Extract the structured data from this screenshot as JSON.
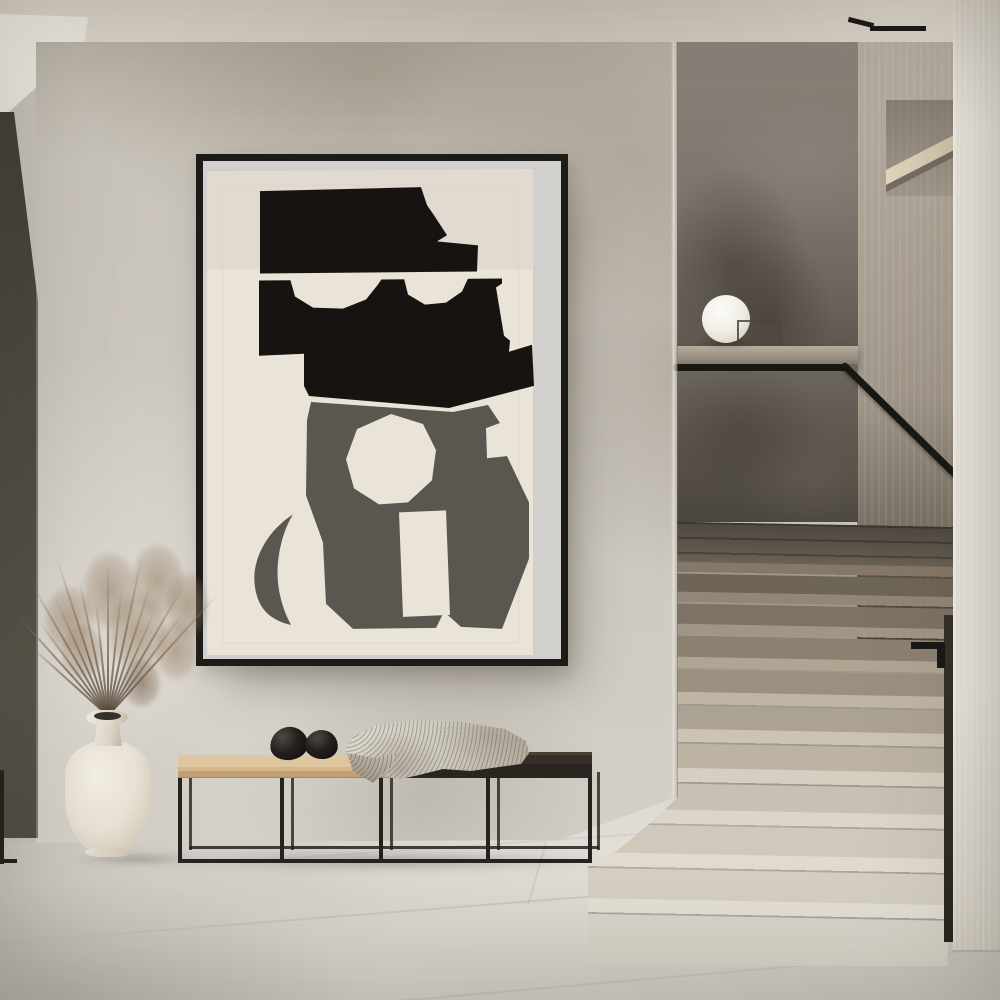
{
  "scene": {
    "description": "Minimalist hallway interior: large black-framed abstract cut-out poster on a plaster wall, black metal bench with beige and dark seat, two black stone eggs and a knit throw, cream vase with dried grass, white sphere lamp on a concrete stair parapet, black handrail and terrazzo stairs beside a white pillar",
    "objects": [
      {
        "label": "abstract poster in black frame"
      },
      {
        "label": "metal frame bench"
      },
      {
        "label": "black stone egg decor"
      },
      {
        "label": "knitted waffle throw"
      },
      {
        "label": "ceramic jar vase"
      },
      {
        "label": "dried grass bouquet"
      },
      {
        "label": "sphere table lamp"
      },
      {
        "label": "terrazzo staircase"
      },
      {
        "label": "black handrail"
      },
      {
        "label": "concrete half wall"
      },
      {
        "label": "wood wall shelf"
      },
      {
        "label": "white pillar"
      }
    ]
  },
  "palette": {
    "ceiling": "#d6cec1",
    "soffit": "#f2f0ea",
    "wall": "#c9c4bb",
    "dark_strip": "#4c4a42",
    "frame": "#1d1b18",
    "art_backing": "#d2d0cd",
    "art_paper": "#eae3d7",
    "art_black": "#161311",
    "art_gray": "#5a5650",
    "bench_metal": "#25221f",
    "bench_seat": "#d7bc93",
    "bench_dark": "#2f2a24",
    "blanket": "#cfcac0",
    "pebble": "#1c1916",
    "vase": "#e9e2d5",
    "grass": "#97816a",
    "panel": "#7d766d",
    "halfwall": "#615a52",
    "ledge": "#a0978a",
    "rail": "#191714",
    "right_wall": "#a89e92",
    "shelf": "#d7cab1",
    "pillar": "#e9e5dd",
    "lamp": "#f8f6f1",
    "floor": "#d2cec7",
    "grout": "#bdb9b2",
    "gap": "#2e2b26"
  },
  "poster": {
    "art_shapes": [
      {
        "name": "backing",
        "type": "rect",
        "x": 0,
        "y": 0,
        "w": 358,
        "h": 496,
        "fill": "art_backing"
      },
      {
        "name": "paper",
        "type": "polygon",
        "points": "4,10 330,8 330,492 4,492",
        "fill": "art_paper"
      },
      {
        "name": "paper-top-shade",
        "type": "rect",
        "x": 4,
        "y": 8,
        "w": 326,
        "h": 100,
        "fill": "#c9c7c3",
        "opacity": 0.3
      },
      {
        "name": "mat-line",
        "type": "rect",
        "x": 20,
        "y": 24,
        "w": 296,
        "h": 456,
        "fill": "none",
        "stroke": "#ded6c8",
        "opacity": 0.8
      },
      {
        "name": "gray-blob",
        "type": "polygon",
        "points": "108,240 250,250 285,243 297,261 283,266 284,296 304,294 326,340 326,396 299,466 258,464 241,449 233,465 150,466 123,441 120,380 103,333 104,258",
        "fill": "art_gray"
      },
      {
        "name": "gray-crescent",
        "type": "path",
        "d": "M 90,352 C 62,370 48,400 52,424 C 55,448 70,458 88,462 C 76,440 72,415 76,392 C 79,374 84,362 90,352 Z",
        "fill": "art_gray"
      },
      {
        "name": "black-hat",
        "type": "polygon",
        "points": "57,30 218,26 224,44 231,54 244,74 234,80 275,84 274,110 57,112",
        "fill": "art_black"
      },
      {
        "name": "black-mass",
        "type": "polygon",
        "points": "56,119 299,117 299,122 293,126 301,174 307,179 306,190 329,183 331,224 246,246 106,234 101,224 101,192 56,194",
        "fill": "art_black"
      },
      {
        "name": "eye-left",
        "type": "polygon",
        "points": "87,117 92,135 110,146 140,147 163,138 175,123 179,117",
        "fill": "art_paper"
      },
      {
        "name": "eye-right",
        "type": "polygon",
        "points": "201,117 205,133 222,143 243,141 259,130 265,117",
        "fill": "art_paper"
      },
      {
        "name": "cream-octagon",
        "type": "polygon",
        "points": "188,252 220,262 233,288 229,318 205,340 176,342 151,326 143,297 154,267",
        "fill": "art_paper"
      },
      {
        "name": "cream-slot",
        "type": "polygon",
        "points": "196,350 243,348 247,452 200,454",
        "fill": "art_paper"
      }
    ]
  },
  "stairs": {
    "visible_step_count": 10,
    "steps": [
      {
        "top": 898,
        "h": 64,
        "split": 14,
        "left": 586,
        "tread": "#e3ded4",
        "riser": "#d8d3c9"
      },
      {
        "top": 852,
        "h": 46,
        "split": 14,
        "left": 586,
        "tread": "#e0dacf",
        "riser": "#d4cec3"
      },
      {
        "top": 808,
        "h": 44,
        "split": 14,
        "left": 586,
        "tread": "#dcd5c9",
        "riser": "#cfc8bb"
      },
      {
        "top": 766,
        "h": 42,
        "split": 14,
        "left": 586,
        "tread": "#d6cec1",
        "riser": "#c8c0b2"
      },
      {
        "top": 727,
        "h": 39,
        "split": 13,
        "left": 586,
        "tread": "#cdc3b4",
        "riser": "#bcb3a3"
      },
      {
        "top": 690,
        "h": 37,
        "split": 12,
        "left": 586,
        "tread": "#c0b5a4",
        "riser": "#aca293"
      },
      {
        "top": 655,
        "h": 35,
        "split": 11,
        "left": 586,
        "tread": "#b0a493",
        "riser": "#9b9080"
      },
      {
        "top": 622,
        "h": 33,
        "split": 10,
        "left": 586,
        "tread": "#a19585",
        "riser": "#8c8171"
      },
      {
        "top": 590,
        "h": 32,
        "split": 10,
        "left": 586,
        "tread": "#938676",
        "riser": "#7d7263"
      },
      {
        "top": 560,
        "h": 30,
        "split": 10,
        "left": 586,
        "tread": "#857868",
        "riser": "#6f6557"
      }
    ]
  },
  "vase": {
    "stem_count": 16
  },
  "lamp": {
    "shape": "sphere"
  }
}
